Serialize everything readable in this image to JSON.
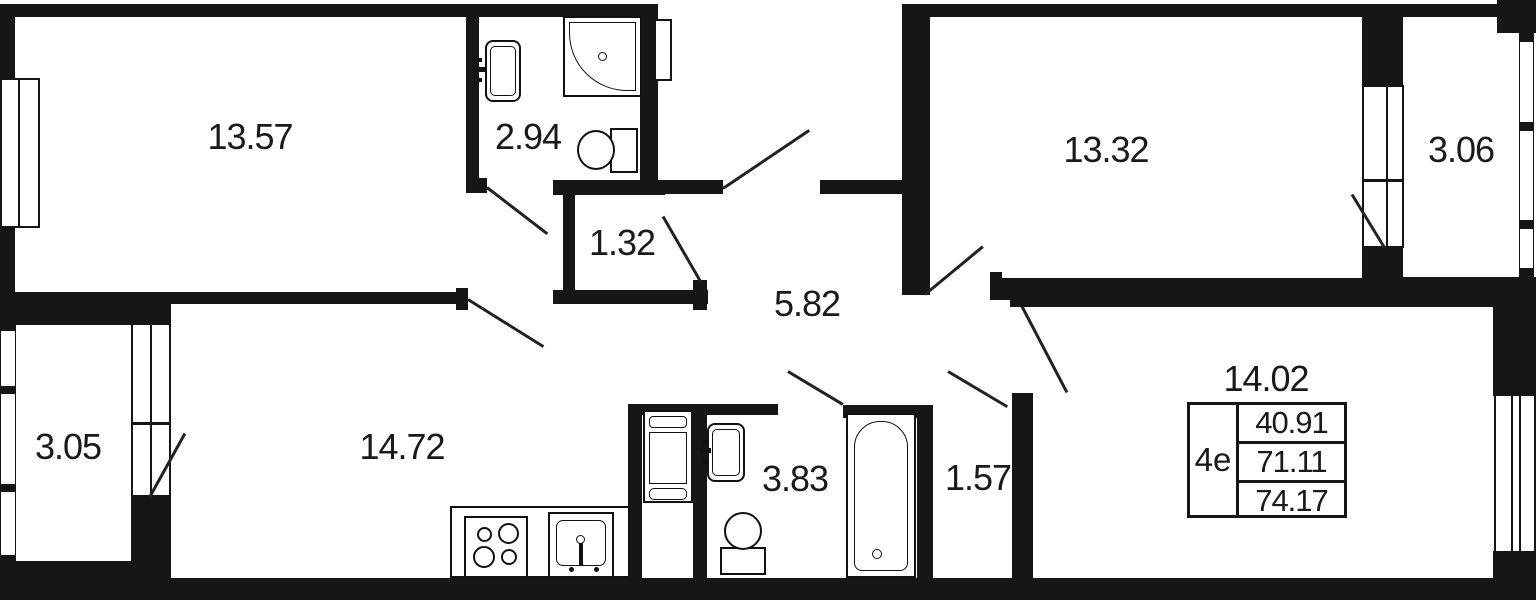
{
  "areas": {
    "bedroom_top_left": "13.57",
    "bathroom_top": "2.94",
    "storage": "1.32",
    "hallway": "5.82",
    "bedroom_top_right": "13.32",
    "loggia_right": "3.06",
    "loggia_left": "3.05",
    "kitchen_living": "14.72",
    "bathroom_bottom": "3.83",
    "hall_small": "1.57",
    "room_bottom_right": "14.02"
  },
  "legend": {
    "plan_type": "4e",
    "rows": [
      "40.91",
      "71.11",
      "74.17"
    ]
  },
  "colors": {
    "wall": "#161616",
    "background": "#ffffff",
    "text": "#1a1a1a"
  }
}
